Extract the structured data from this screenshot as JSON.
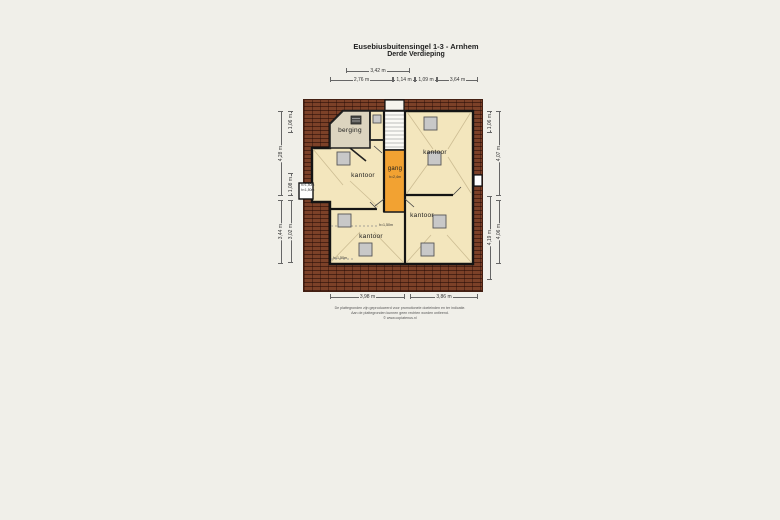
{
  "title": {
    "line1": "Eusebiusbuitensingel 1-3 - Arnhem",
    "line2": "Derde Verdieping"
  },
  "rooms": {
    "berging": "berging",
    "kantoor_nw": "kantoor",
    "kantoor_ne": "kantoor",
    "kantoor_sw": "kantoor",
    "kantoor_se": "kantoor",
    "gang": "gang"
  },
  "annotations": {
    "gang_height": "h=2,4m",
    "sw_height": "h=1,50m",
    "sw_corner": "h=1,50m",
    "entry_line1": "h>1,50m",
    "entry_line2": "h<1,50m"
  },
  "dims": {
    "t1": [
      "3,42 m"
    ],
    "t2": [
      "2,76 m",
      "1,14 m",
      "1,09 m",
      "3,64 m"
    ],
    "lo": [
      "4,28 m",
      "3,44 m"
    ],
    "li": [
      "1,06 m",
      "1,08 m",
      "3,02 m"
    ],
    "ri": [
      "1,06 m",
      "4,19 m"
    ],
    "ro": [
      "4,07 m",
      "4,06 m"
    ],
    "b": [
      "3,98 m",
      "3,86 m"
    ]
  },
  "disclaimer": {
    "line1": "De plattegronden zijn geproduceerd voor promotionele doeleinden en ter indicatie.",
    "line2": "Aan de plattegronden kunnen geen rechten worden ontleend.",
    "line3": "© www.copiatenus.nl"
  },
  "colors": {
    "brick": "#7c4128",
    "room_fill": "#f3e6bd",
    "berging_fill": "#dcd4bf",
    "gang_fill": "#f2a232",
    "wall": "#141414",
    "roof_window": "#c8c8c8"
  }
}
